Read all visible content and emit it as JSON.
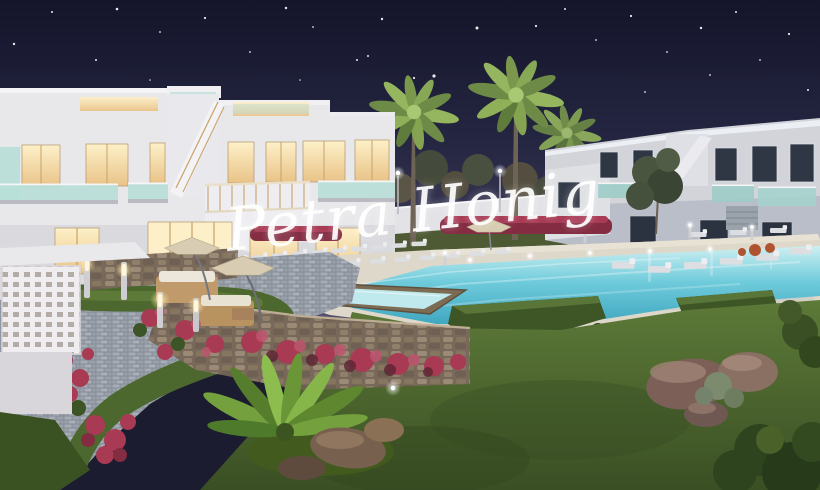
{
  "scene": {
    "alt_text": "Night-time 3D architectural rendering of a white two-storey Mediterranean apartment complex with warmly lit windows, glass balconies and exterior stairs, uplit palm trees, landscaped gardens with pink bougainvillea, winding paver paths, lounge furniture with parasols, sun loungers and a large turquoise swimming pool with a raised jacuzzi, under a starry dark-blue sky",
    "watermark": {
      "text": "Petra Honig"
    },
    "colors": {
      "sky_top": "#14152a",
      "sky_mid": "#252642",
      "sky_horizon": "#565170",
      "building_white": "#e8e7ea",
      "building_dim": "#d2d4da",
      "building_shadow": "#b8bbc5",
      "window_glow": "#f6e0a8",
      "window_glow_bright": "#fdf0c8",
      "window_dark": "#2f3644",
      "glass_teal": "#b7ded8",
      "glass_teal_dim": "#9cccc6",
      "frame_tan": "#c7a268",
      "pool_far": "#cdf0f2",
      "pool_mid": "#6fcbdb",
      "pool_near": "#3ea6bf",
      "deck_beige": "#ded8cb",
      "gravel": "#cfcfc9",
      "paver": "#9aa1ab",
      "stone": "#867664",
      "wood_brown": "#7d6c54",
      "grass_light": "#5d7a38",
      "grass_dark": "#3f5526",
      "hedge_green": "#3e5626",
      "bougainvillea": "#a83a54",
      "bougainvillea_dark": "#832c42",
      "palm_light": "#95b55e",
      "palm_dark": "#6d8a46",
      "pine": "#4c4f3e",
      "trunk": "#6e6455",
      "parasol": "#d8cdb2",
      "lounger": "#dcdee2",
      "rattan": "#c09a6a",
      "rock": "#7c6058",
      "lamp_warm": "#ffeebb",
      "lamp_cool": "#ffffff"
    }
  },
  "stars": [
    {
      "x": 14,
      "y": 44,
      "r": 1.2
    },
    {
      "x": 52,
      "y": 12,
      "r": 1.0
    },
    {
      "x": 117,
      "y": 9,
      "r": 1.3
    },
    {
      "x": 160,
      "y": 32,
      "r": 0.9
    },
    {
      "x": 96,
      "y": 60,
      "r": 1.0
    },
    {
      "x": 205,
      "y": 18,
      "r": 1.1
    },
    {
      "x": 250,
      "y": 52,
      "r": 0.9
    },
    {
      "x": 286,
      "y": 8,
      "r": 1.2
    },
    {
      "x": 313,
      "y": 27,
      "r": 0.9
    },
    {
      "x": 382,
      "y": 19,
      "r": 1.2
    },
    {
      "x": 357,
      "y": 60,
      "r": 1.0
    },
    {
      "x": 414,
      "y": 78,
      "r": 1.1
    },
    {
      "x": 434,
      "y": 76,
      "r": 1.6
    },
    {
      "x": 477,
      "y": 28,
      "r": 1.5
    },
    {
      "x": 368,
      "y": 56,
      "r": 1.0
    },
    {
      "x": 536,
      "y": 26,
      "r": 1.1
    },
    {
      "x": 565,
      "y": 9,
      "r": 1.0
    },
    {
      "x": 596,
      "y": 40,
      "r": 0.9
    },
    {
      "x": 631,
      "y": 16,
      "r": 1.1
    },
    {
      "x": 667,
      "y": 52,
      "r": 0.9
    },
    {
      "x": 701,
      "y": 28,
      "r": 1.2
    },
    {
      "x": 736,
      "y": 12,
      "r": 1.0
    },
    {
      "x": 760,
      "y": 60,
      "r": 0.9
    },
    {
      "x": 789,
      "y": 34,
      "r": 1.1
    },
    {
      "x": 808,
      "y": 90,
      "r": 1.0
    },
    {
      "x": 645,
      "y": 92,
      "r": 0.9
    },
    {
      "x": 550,
      "y": 95,
      "r": 0.8
    },
    {
      "x": 300,
      "y": 80,
      "r": 0.8
    },
    {
      "x": 150,
      "y": 80,
      "r": 0.8
    },
    {
      "x": 710,
      "y": 75,
      "r": 0.9
    }
  ]
}
